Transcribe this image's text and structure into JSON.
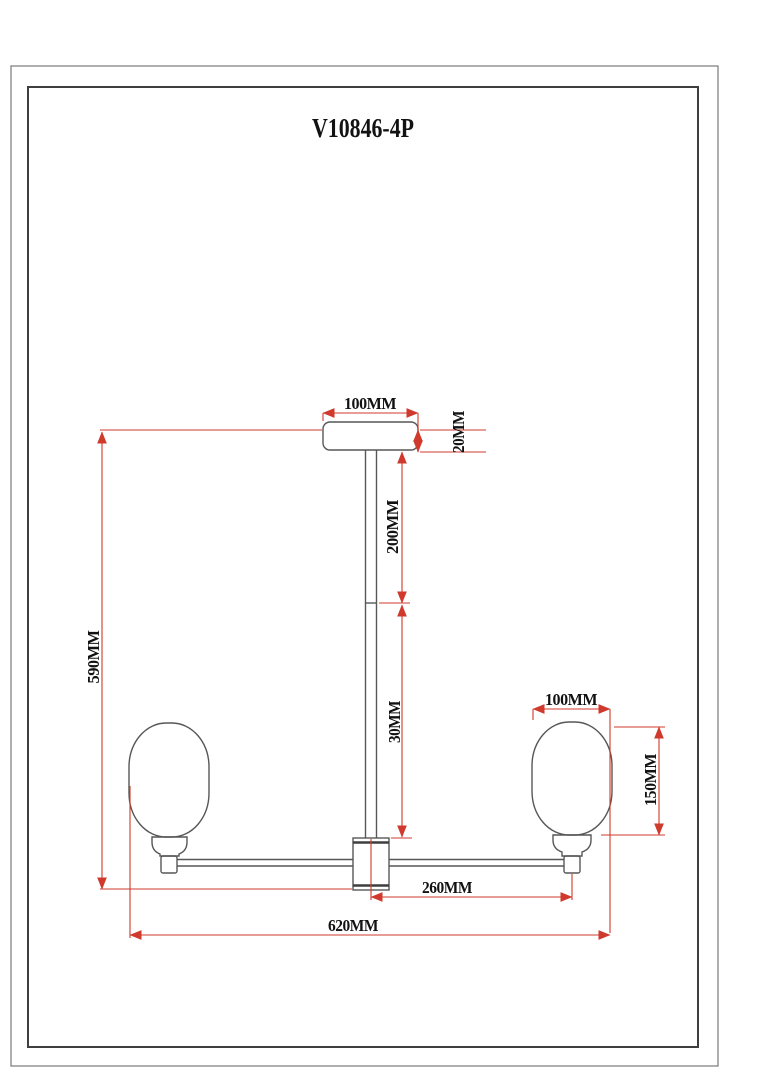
{
  "title": "V10846-4P",
  "colors": {
    "dimension_red": "#cf3a2c",
    "drawing_gray": "#575757",
    "frame_dark": "#3f3f3f",
    "background": "#ffffff"
  },
  "dimensions": {
    "canopy_width": "100MM",
    "canopy_height": "20MM",
    "upper_rod_length": "200MM",
    "lower_rod_length": "30MM",
    "total_height": "590MM",
    "shade_width": "100MM",
    "shade_height": "150MM",
    "arm_center_to_shade": "260MM",
    "total_width": "620MM"
  }
}
